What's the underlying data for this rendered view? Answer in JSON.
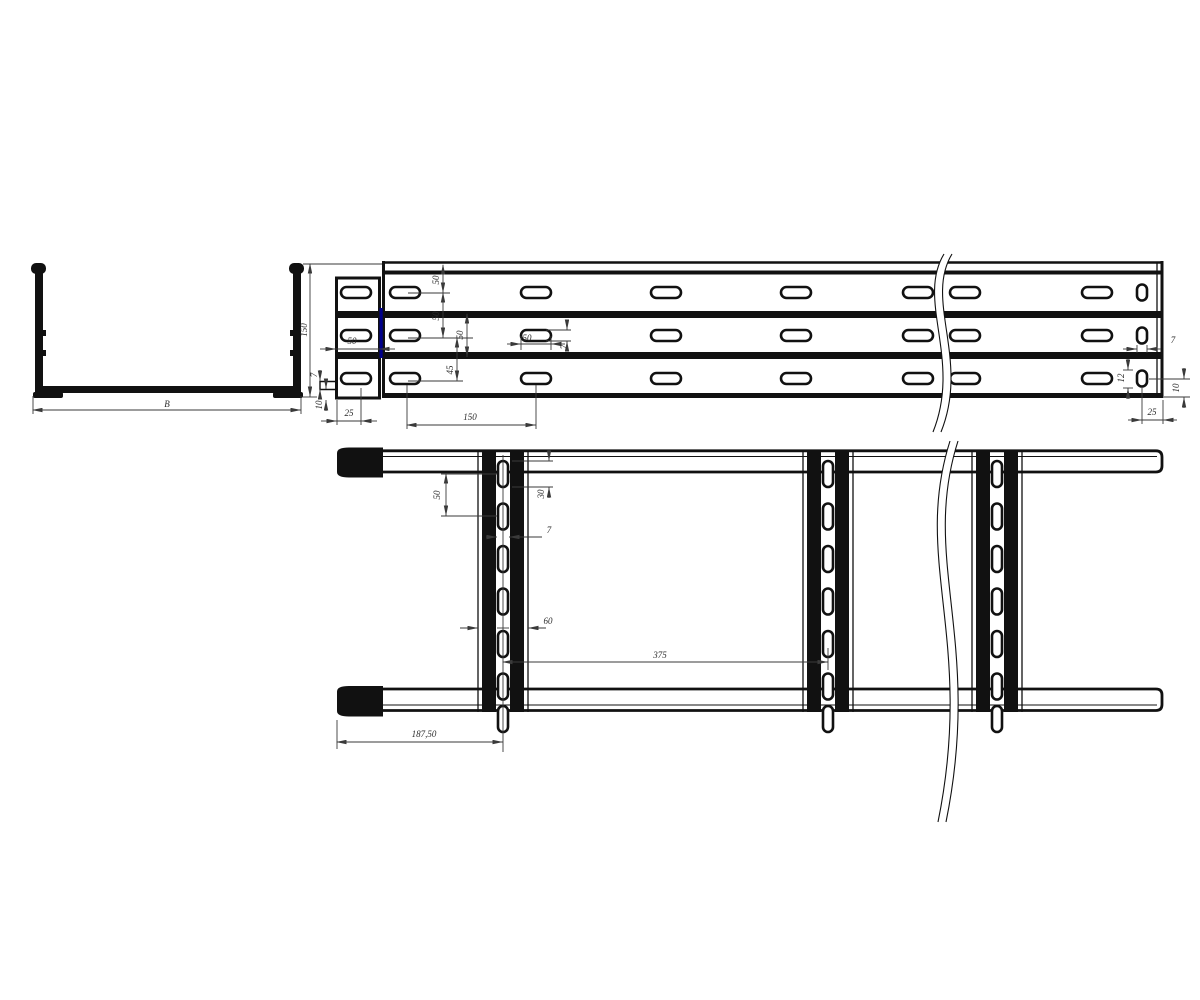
{
  "colors": {
    "background": "#ffffff",
    "line": "#111111",
    "dimension": "#3a3a3a",
    "artifact": "#00008b"
  },
  "views": {
    "cross_section": "channel-cross-section",
    "side_view": "side-elevation",
    "plan_view": "plan-view"
  },
  "labels": {
    "section_width": "B",
    "section_height": "150",
    "coupler_width": "50",
    "coupler_end_offset": "25",
    "coupler_tab_thickness": "7",
    "coupler_tab_offset": "10",
    "row1_offset": "50",
    "row2_spacing": "50",
    "web_spacing": "50",
    "row3_spacing": "45",
    "slot_length": "50",
    "slot_width": "7",
    "slot_pitch": "150",
    "end_slot_width": "7",
    "end_slot_height": "12",
    "end_slot_bottom_offset": "10",
    "end_slot_end_offset": "25",
    "rung_slot_pitch": "50",
    "rung_slot_length": "30",
    "rung_slot_width": "7",
    "rung_width": "60",
    "rung_pitch": "375",
    "first_rung_offset": "187,50"
  }
}
